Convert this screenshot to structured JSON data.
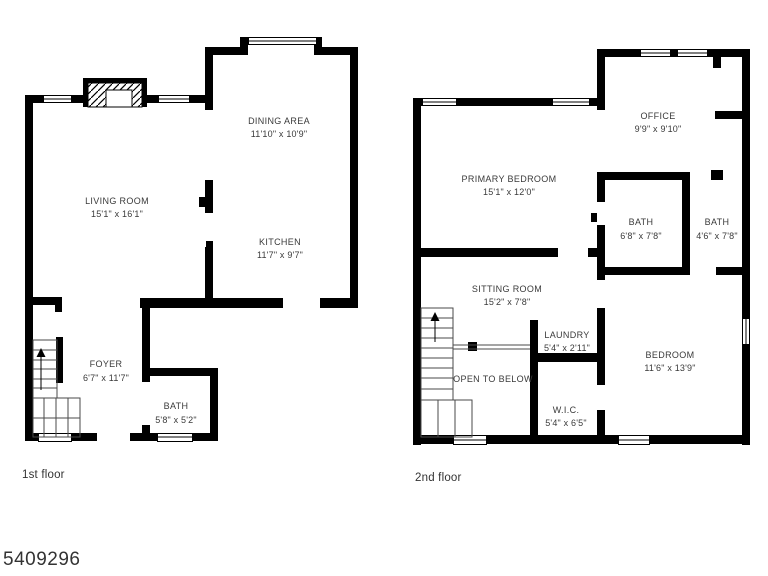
{
  "watermark": "5409296",
  "colors": {
    "wall": "#000000",
    "label_text": "#3a3a3a",
    "background": "#ffffff"
  },
  "floor1": {
    "label": "1st floor",
    "rooms": {
      "living_room": {
        "name": "LIVING ROOM",
        "dims": "15'1\" x 16'1\""
      },
      "dining_area": {
        "name": "DINING AREA",
        "dims": "11'10\" x 10'9\""
      },
      "kitchen": {
        "name": "KITCHEN",
        "dims": "11'7\" x 9'7\""
      },
      "foyer": {
        "name": "FOYER",
        "dims": "6'7\" x 11'7\""
      },
      "bath": {
        "name": "BATH",
        "dims": "5'8\" x 5'2\""
      }
    }
  },
  "floor2": {
    "label": "2nd floor",
    "rooms": {
      "primary_bedroom": {
        "name": "PRIMARY BEDROOM",
        "dims": "15'1\" x 12'0\""
      },
      "office": {
        "name": "OFFICE",
        "dims": "9'9\" x 9'10\""
      },
      "bath_1": {
        "name": "BATH",
        "dims": "6'8\" x 7'8\""
      },
      "bath_2": {
        "name": "BATH",
        "dims": "4'6\" x 7'8\""
      },
      "sitting_room": {
        "name": "SITTING ROOM",
        "dims": "15'2\" x 7'8\""
      },
      "laundry": {
        "name": "LAUNDRY",
        "dims": "5'4\" x 2'11\""
      },
      "open_to_below": {
        "name": "OPEN TO BELOW"
      },
      "wic": {
        "name": "W.I.C.",
        "dims": "5'4\" x 6'5\""
      },
      "bedroom": {
        "name": "BEDROOM",
        "dims": "11'6\" x 13'9\""
      }
    }
  }
}
